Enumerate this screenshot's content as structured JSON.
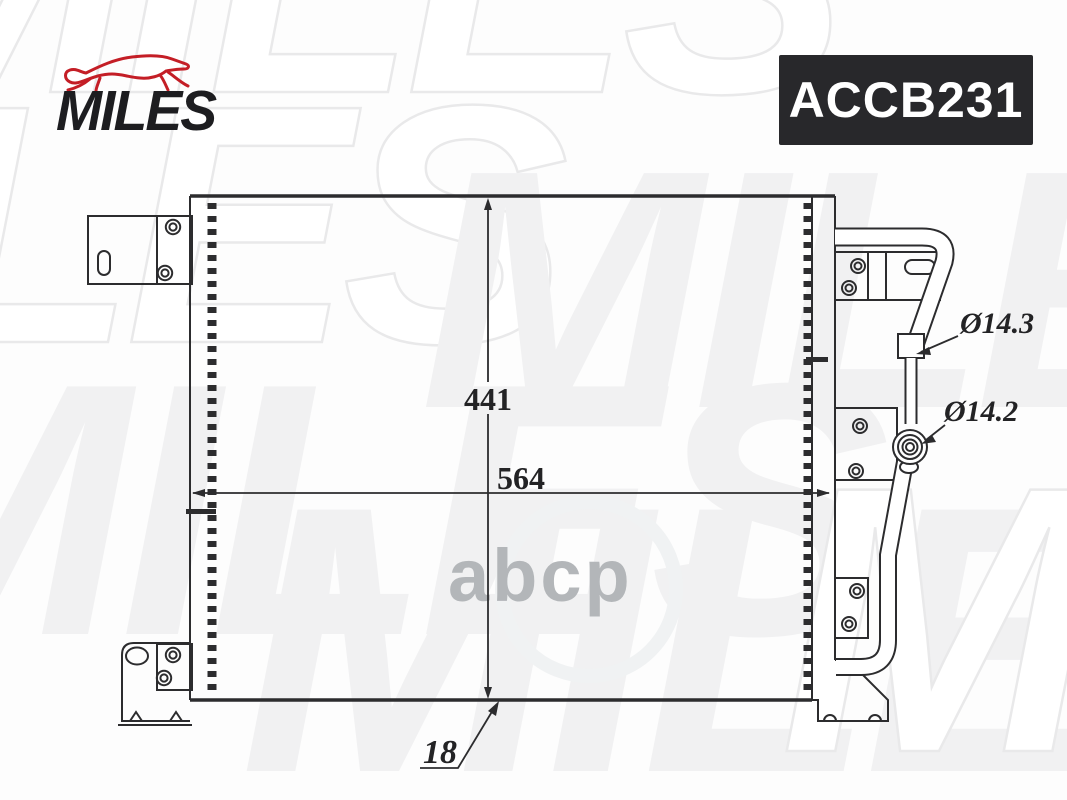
{
  "brand": {
    "logo_text": "MILES",
    "logo_color": "#1d1d20",
    "dog_icon_color": "#c41e26"
  },
  "part_badge": {
    "code": "ACCB231",
    "background": "#28282b",
    "text_color": "#ffffff"
  },
  "watermarks": {
    "tile_text": "MILES",
    "center_logo_text": "abcp",
    "center_logo_color": "#b3b6b9",
    "tile_color": "#f1f1f2"
  },
  "drawing": {
    "height_mm": "441",
    "width_mm": "564",
    "depth_mm": "18",
    "diameter_top": "Ø14.3",
    "diameter_bottom": "Ø14.2",
    "line_color": "#2c2c2e"
  }
}
